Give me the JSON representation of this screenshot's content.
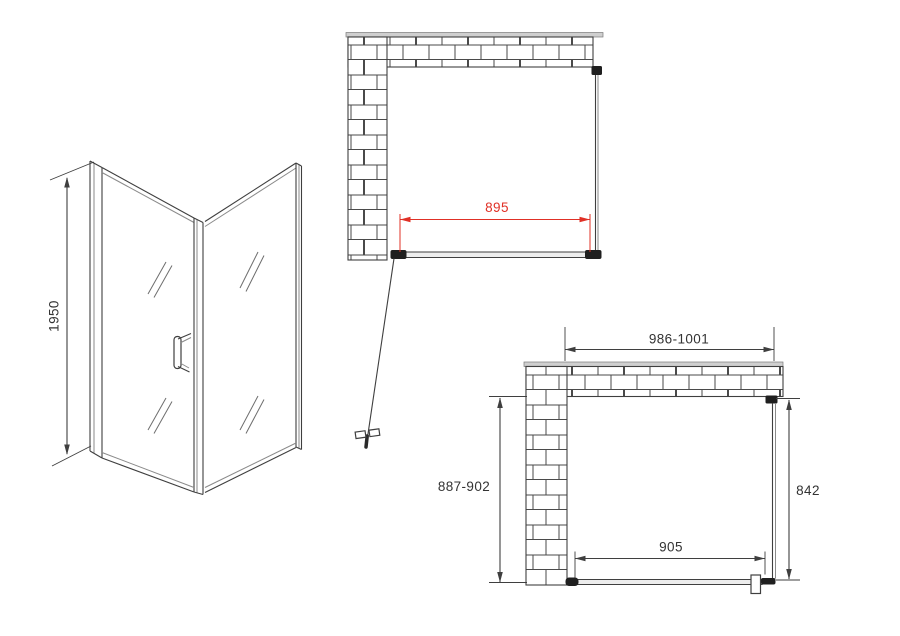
{
  "drawing": {
    "type": "shower-enclosure-technical-drawing",
    "colors": {
      "line": "#3f3f3f",
      "dimension_red": "#e03026",
      "wall_cap": "#cfcfcf"
    },
    "iso_view": {
      "height_label": "1950"
    },
    "top_plan_view": {
      "door_width_label": "895"
    },
    "bottom_plan_view": {
      "overall_width_label": "986-1001",
      "overall_depth_label": "887-902",
      "side_panel_label": "842",
      "door_opening_label": "905"
    }
  }
}
